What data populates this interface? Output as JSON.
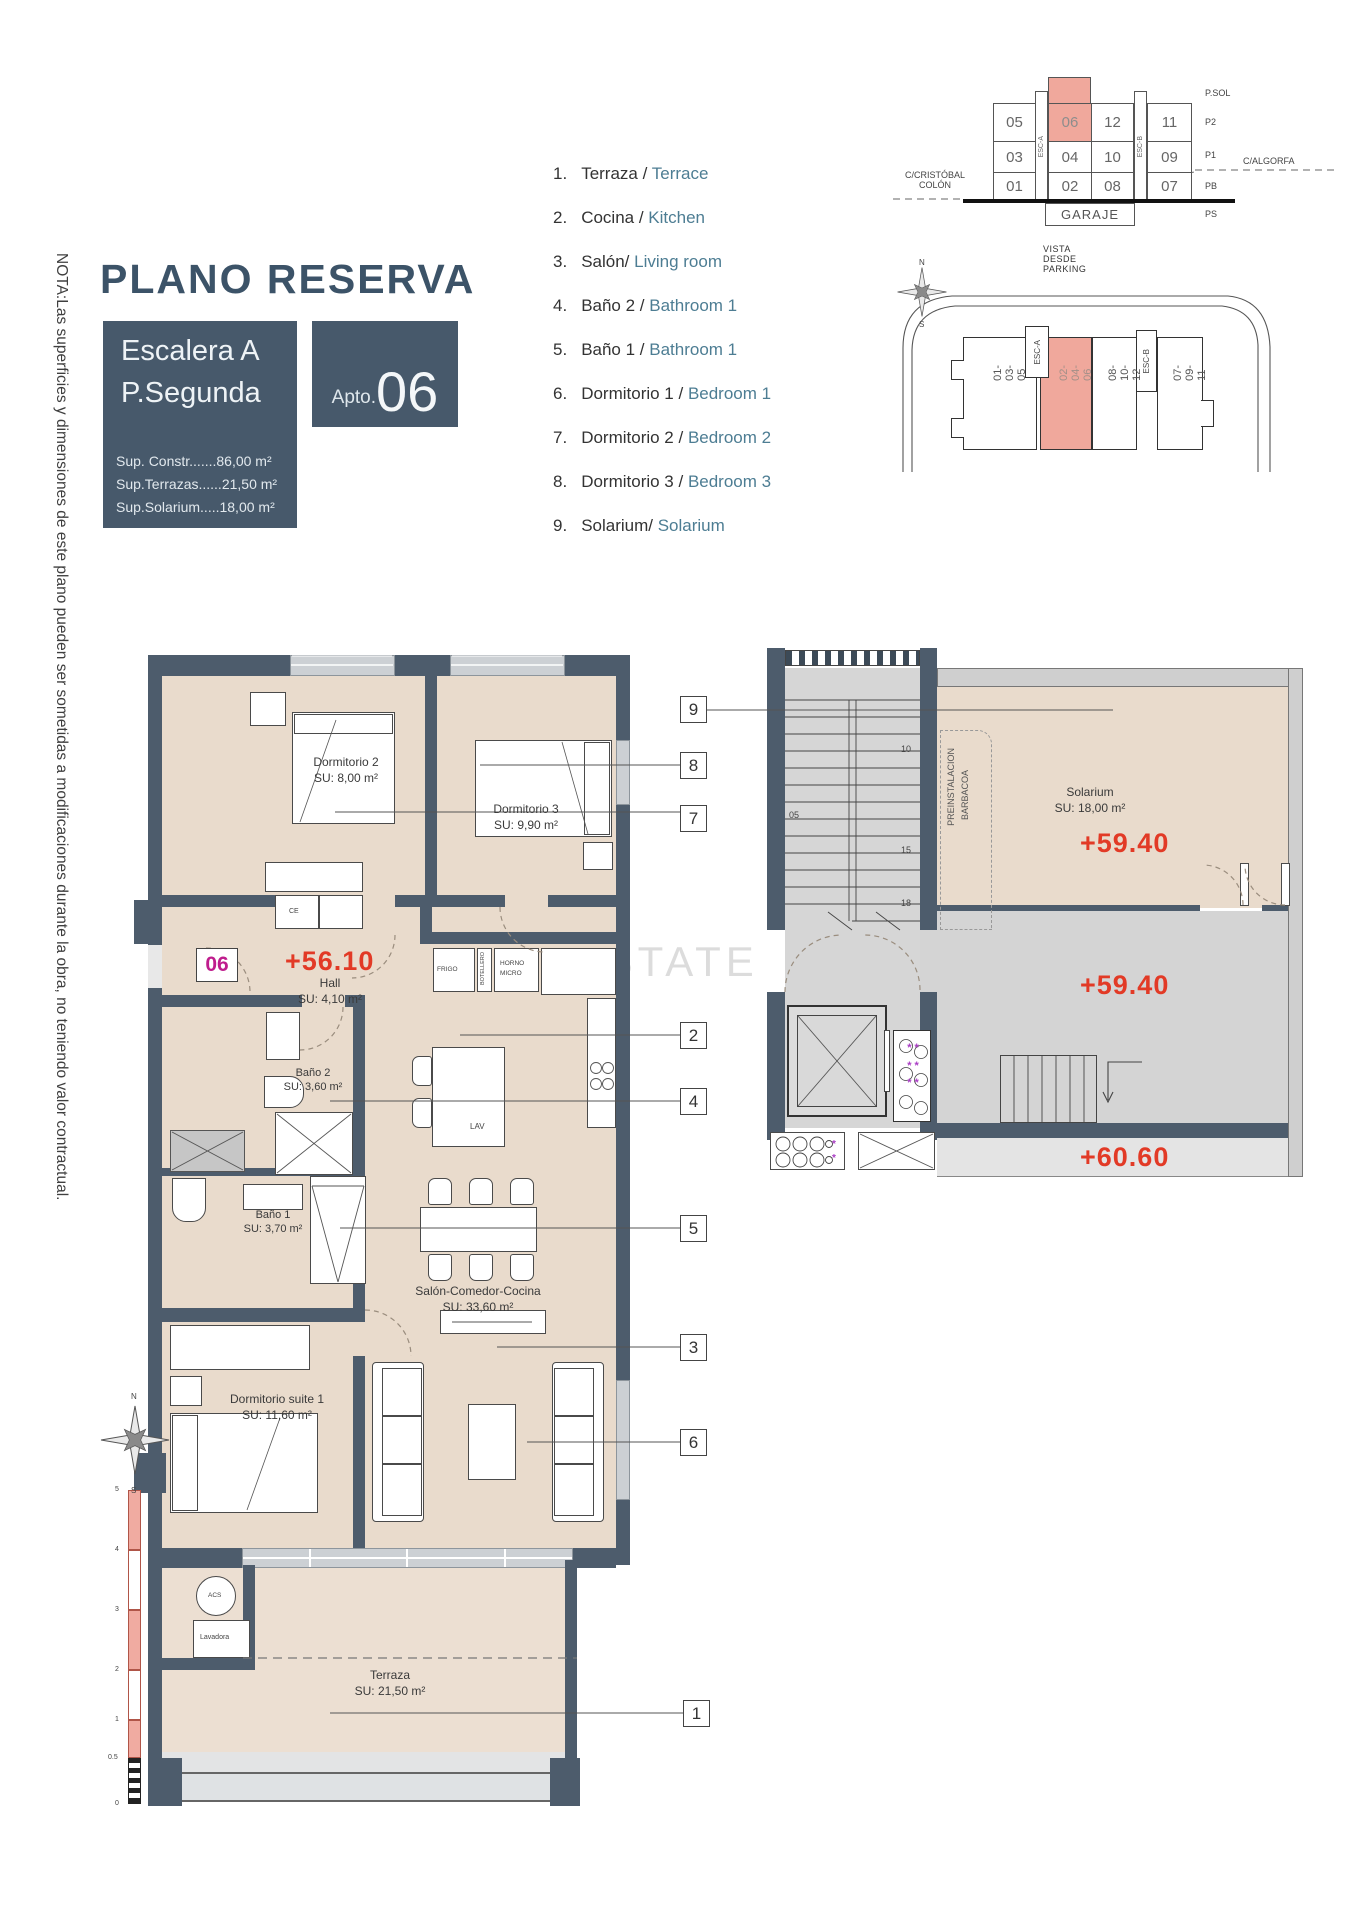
{
  "note_vertical": "NOTA:Las superficies y dimensiones de este plano pueden ser sometidas a modificaciones durante la obra, no teniendo valor contractual.",
  "header": {
    "title": "PLANO RESERVA",
    "block_line1": "Escalera A",
    "block_line2": "P.Segunda",
    "apto_prefix": "Apto.",
    "apto_number": "06",
    "surfaces": [
      "Sup. Constr.......86,00 m²",
      "Sup.Terrazas......21,50 m²",
      "Sup.Solarium.....18,00 m²"
    ]
  },
  "legend": {
    "items": [
      {
        "num": "1.",
        "es": "Terraza / ",
        "en": "Terrace"
      },
      {
        "num": "2.",
        "es": "Cocina / ",
        "en": "Kitchen"
      },
      {
        "num": "3.",
        "es": "Salón/ ",
        "en": "Living room"
      },
      {
        "num": "4.",
        "es": "Baño 2 / ",
        "en": "Bathroom 1"
      },
      {
        "num": "5.",
        "es": "Baño 1 / ",
        "en": "Bathroom 1"
      },
      {
        "num": "6.",
        "es": "Dormitorio 1 / ",
        "en": "Bedroom 1"
      },
      {
        "num": "7.",
        "es": "Dormitorio 2 / ",
        "en": "Bedroom 2"
      },
      {
        "num": "8.",
        "es": "Dormitorio 3 / ",
        "en": "Bedroom 3"
      },
      {
        "num": "9.",
        "es": "Solarium/ ",
        "en": "Solarium"
      }
    ]
  },
  "section": {
    "street_left1": "C/CRISTÓBAL",
    "street_left2": "COLÓN",
    "street_right": "C/ALGORFA",
    "rows": [
      [
        "05",
        "06",
        "12",
        "11"
      ],
      [
        "03",
        "04",
        "10",
        "09"
      ],
      [
        "01",
        "02",
        "08",
        "07"
      ]
    ],
    "esc_a": "ESC-A",
    "esc_b": "ESC-B",
    "garaje": "GARAJE",
    "levels": [
      "P.SOL",
      "P2",
      "P1",
      "PB",
      "PS"
    ],
    "caption": "VISTA DESDE PARKING"
  },
  "site": {
    "b1": "01-03-05",
    "b2": "02-04-06",
    "b3": "08-10-12",
    "b4": "07-09-11",
    "esc_a": "ESC-A",
    "esc_b": "ESC-B"
  },
  "plan": {
    "badge": "06",
    "level": "+56.10",
    "dorm2": {
      "name": "Dormitorio 2",
      "area": "SU: 8,00 m²"
    },
    "dorm3": {
      "name": "Dormitorio 3",
      "area": "SU: 9,90 m²"
    },
    "hall": {
      "name": "Hall",
      "area": "SU: 4,10 m²"
    },
    "bano2": {
      "name": "Baño 2",
      "area": "SU: 3,60 m²"
    },
    "bano1": {
      "name": "Baño 1",
      "area": "SU: 3,70 m²"
    },
    "salon": {
      "name": "Salón-Comedor-Cocina",
      "area": "SU: 33,60 m²"
    },
    "suite": {
      "name": "Dormitorio suite 1",
      "area": "SU: 11,60 m²"
    },
    "terraza": {
      "name": "Terraza",
      "area": "SU: 21,50 m²"
    },
    "frigo": "FRIGO",
    "botellero": "BOTELLERO",
    "horno1": "HORNO",
    "horno2": "MICRO",
    "lav": "LAV",
    "ce": "CE",
    "acs": "ACS",
    "lavadora": "Lavadora"
  },
  "sol": {
    "name": "Solarium",
    "area": "SU: 18,00 m²",
    "lvl1": "+59.40",
    "lvl2": "+59.40",
    "lvl3": "+60.60",
    "pre1": "PREINSTALACION",
    "pre2": "BARBACOA",
    "s05": "05",
    "s10": "10",
    "s15": "15",
    "s18": "18"
  },
  "callouts": {
    "n1": "1",
    "n2": "2",
    "n3": "3",
    "n4": "4",
    "n5": "5",
    "n6": "6",
    "n7": "7",
    "n8": "8",
    "n9": "9"
  },
  "compass": {
    "n": "N",
    "s": "S"
  },
  "scale": {
    "l5": "5",
    "l4": "4",
    "l3": "3",
    "l2": "2",
    "l1": "1",
    "l05": "0.5",
    "l0": "0"
  },
  "watermark": "- ESTATE SPA",
  "colors": {
    "slate": "#47596b",
    "pink": "#f0a89c",
    "red": "#e23a26",
    "magenta": "#bf1d8d",
    "legend_en": "#4d7d93"
  }
}
